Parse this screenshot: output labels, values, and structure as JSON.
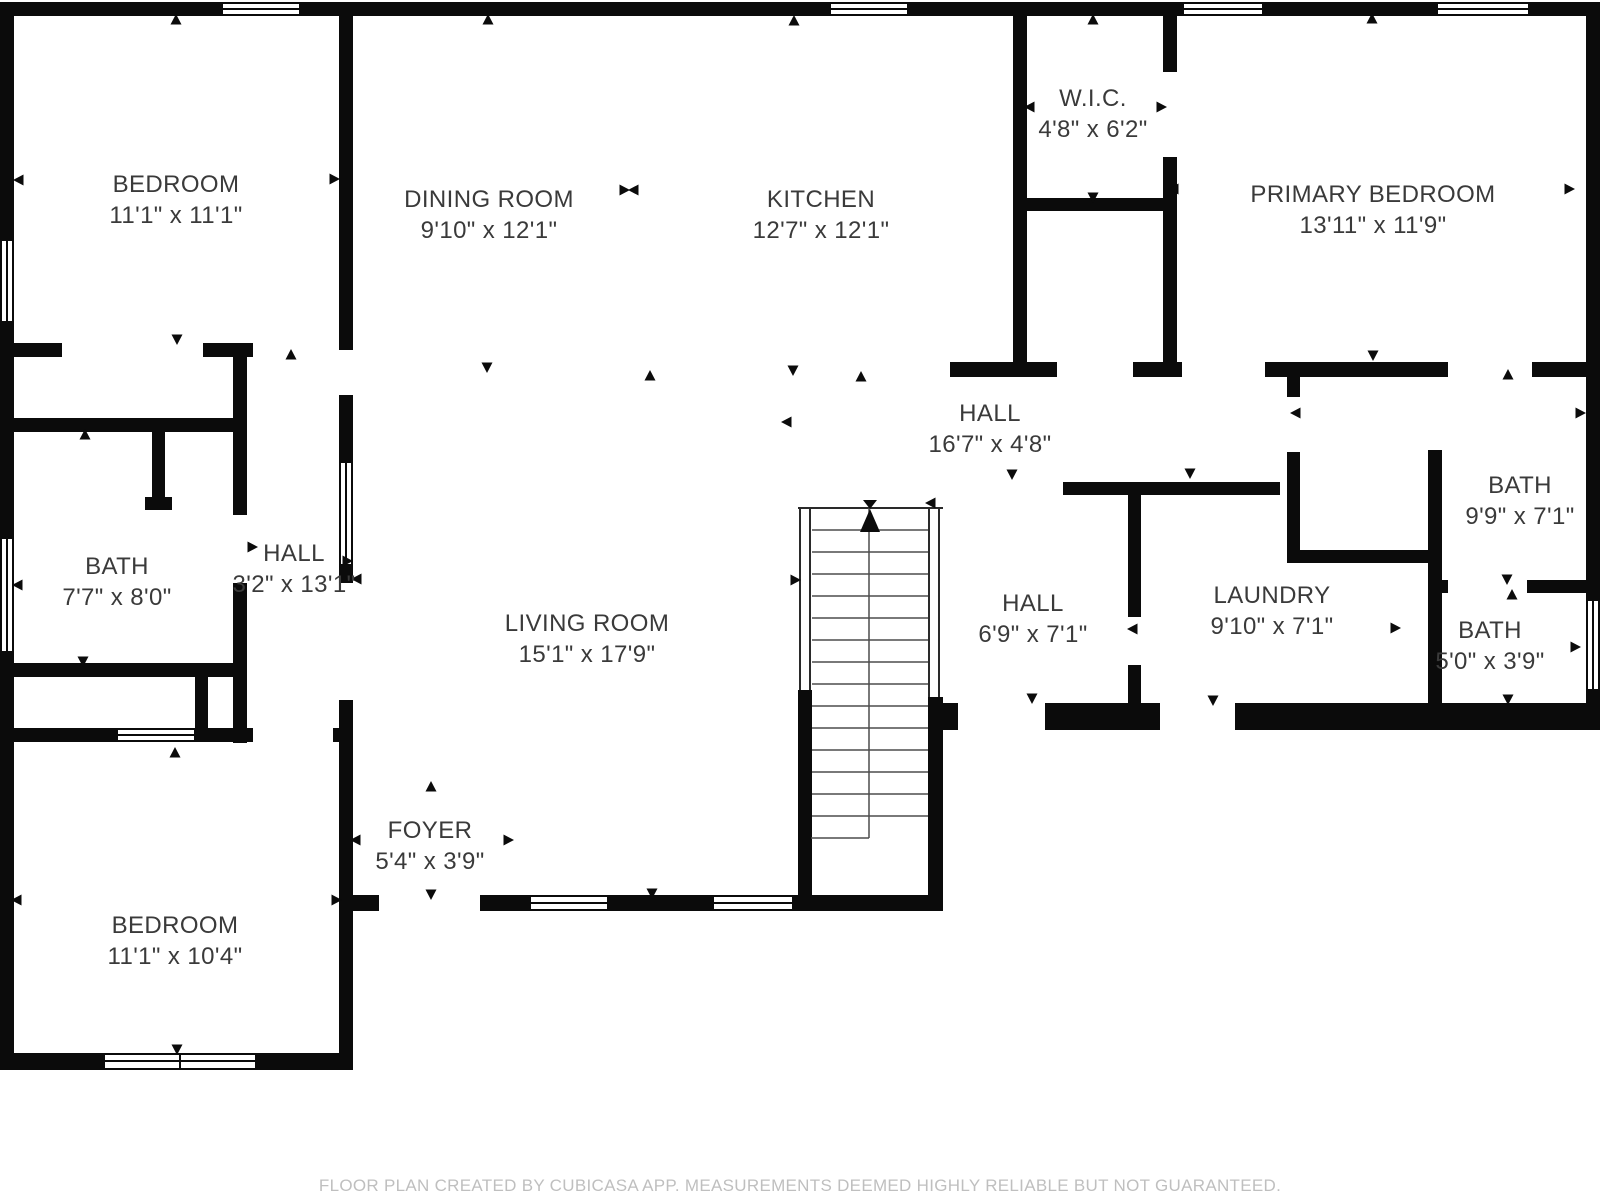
{
  "floor_plan": {
    "rooms": [
      {
        "name": "BEDROOM",
        "dims": "11'1\" x 11'1\""
      },
      {
        "name": "DINING ROOM",
        "dims": "9'10\" x 12'1\""
      },
      {
        "name": "KITCHEN",
        "dims": "12'7\" x 12'1\""
      },
      {
        "name": "W.I.C.",
        "dims": "4'8\" x 6'2\""
      },
      {
        "name": "PRIMARY BEDROOM",
        "dims": "13'11\" x 11'9\""
      },
      {
        "name": "HALL",
        "dims": "16'7\" x 4'8\""
      },
      {
        "name": "BATH",
        "dims": "7'7\" x 8'0\""
      },
      {
        "name": "HALL",
        "dims": "3'2\" x 13'1\""
      },
      {
        "name": "LIVING ROOM",
        "dims": "15'1\" x 17'9\""
      },
      {
        "name": "HALL",
        "dims": "6'9\" x 7'1\""
      },
      {
        "name": "LAUNDRY",
        "dims": "9'10\" x 7'1\""
      },
      {
        "name": "BATH",
        "dims": "9'9\" x 7'1\""
      },
      {
        "name": "BATH",
        "dims": "5'0\" x 3'9\""
      },
      {
        "name": "FOYER",
        "dims": "5'4\" x 3'9\""
      },
      {
        "name": "BEDROOM",
        "dims": "11'1\" x 10'4\""
      }
    ],
    "footer": "FLOOR PLAN CREATED BY CUBICASA APP. MEASUREMENTS DEEMED HIGHLY RELIABLE BUT NOT GUARANTEED.",
    "colors": {
      "wall": "#0b0b0b",
      "label": "#3a3a3a",
      "footer": "#bfbfbf"
    }
  }
}
